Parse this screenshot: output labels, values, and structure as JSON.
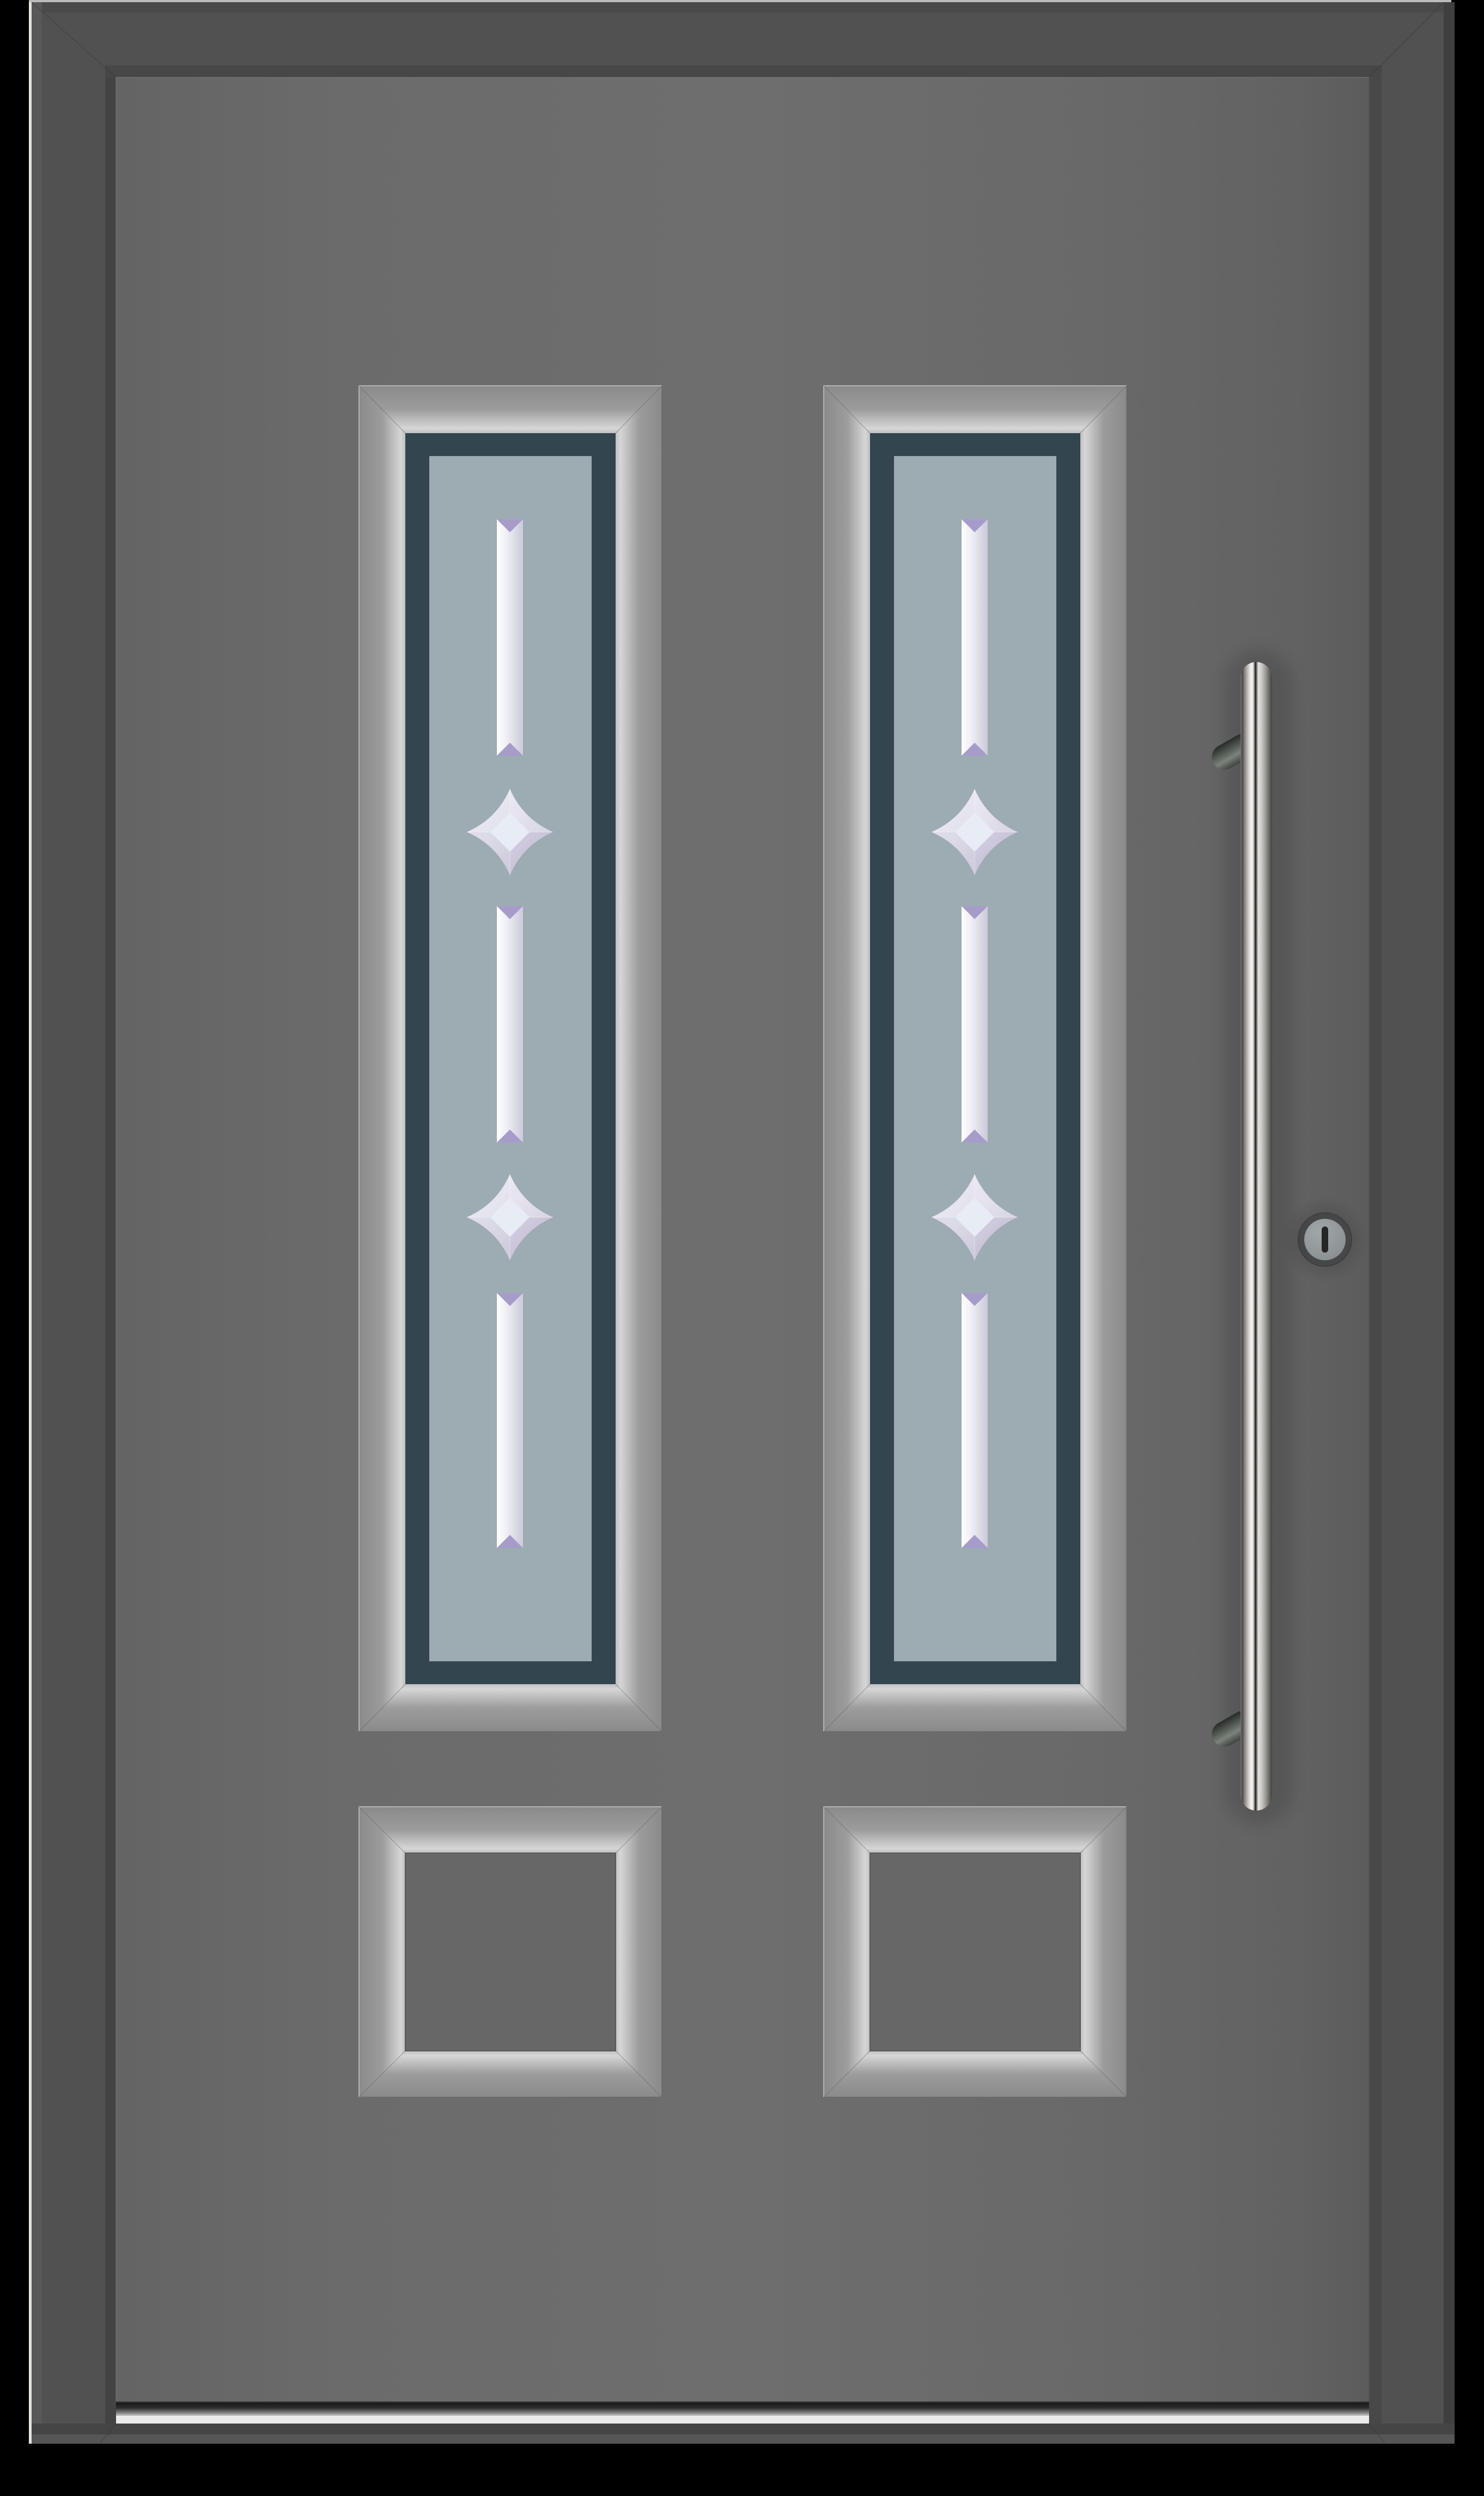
{
  "scene": {
    "description": "Product render of a grey aluminium entrance door with two vertical glazed panels, bevelled glass decoration, two solid bottom panels, a stainless-steel bar pull handle and a cylinder keyhole",
    "glazed_panels": 2,
    "solid_bottom_panels": 2,
    "bevel_bars_per_glazed_panel": 3,
    "bevel_stars_per_glazed_panel": 2,
    "handle_type": "vertical bar pull",
    "lock_type": "cylinder keyhole",
    "threshold_type": "aluminium threshold strip"
  },
  "colors": {
    "background": "#000000",
    "frame_face": "#515151",
    "frame_outer_band": "#585858",
    "frame_top_strip": "#bcbcbc",
    "frame_edge_light": "#e6e4e0",
    "leaf": "#6b6b6b",
    "glazing_frame": "#33454f",
    "glass": "#9dabb3",
    "bevel_white": "#f2f2f7",
    "bevel_purple": "#a79cc9",
    "panel_recess": "#676767",
    "handle_steel_light": "#f6f2ef",
    "handle_steel_dark": "#3c3c3c",
    "lock_face": "#878e91",
    "keyhole": "#262626",
    "threshold_strip": "#ebebeb"
  }
}
